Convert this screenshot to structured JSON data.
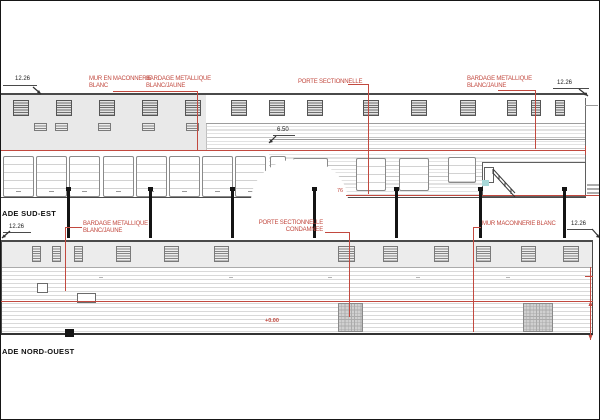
{
  "drawing": {
    "colors": {
      "annotation_red": "#c2493f",
      "line_dark": "#4a4a4a",
      "wall_gray": "#e9e9e9",
      "strip_gray": "#ececec",
      "teal_accent": "#a8d8d8"
    },
    "facades": {
      "sud_est": {
        "title": "ADE SUD-EST",
        "labels": {
          "mur": {
            "l1": "MUR EN MACONNERIE",
            "l2": "BLANC"
          },
          "bardage_left": {
            "l1": "BARDAGE METALLIQUE",
            "l2": "BLANC/JAUNE"
          },
          "porte": {
            "l1": "PORTE SECTIONNELLE"
          },
          "bardage_right": {
            "l1": "BARDAGE METALLIQUE",
            "l2": "BLANC/JAUNE"
          }
        },
        "dims": {
          "height_left": "12.26",
          "height_right": "12.26",
          "eave": "6.50",
          "length": "76"
        }
      },
      "nord_ouest": {
        "title": "ADE NORD-OUEST",
        "labels": {
          "bardage": {
            "l1": "BARDAGE METALLIQUE",
            "l2": "BLANC/JAUNE"
          },
          "porte_condamnee": {
            "l1": "PORTE SECTIONNELLE",
            "l2": "CONDAMNEE"
          },
          "mur": {
            "l1": "MUR MACONNERIE BLANC"
          }
        },
        "dims": {
          "height_left": "12.26",
          "height_right": "12.26",
          "level": "+0.00"
        }
      }
    }
  }
}
